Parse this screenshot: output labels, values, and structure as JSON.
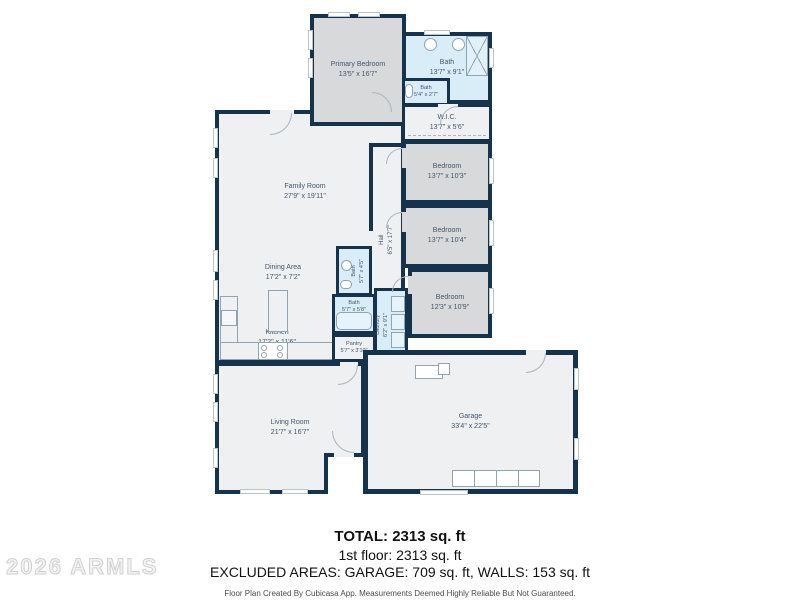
{
  "watermark": "2026 ARMLS",
  "summary": {
    "total": "TOTAL: 2313 sq. ft",
    "floor1": "1st floor: 2313 sq. ft",
    "excluded": "EXCLUDED AREAS: GARAGE: 709 sq. ft, WALLS: 153 sq. ft",
    "disclaimer": "Floor Plan Created By Cubicasa App. Measurements Deemed Highly Reliable But Not Guaranteed."
  },
  "colors": {
    "wall": "#16334e",
    "room_light": "#eef0f2",
    "room_gray": "#d7d9da",
    "room_blue": "#d9edf9",
    "label_text": "#44566b"
  },
  "rooms": {
    "primary_bedroom": {
      "name": "Primary Bedroom",
      "dims": "13'5\" x 16'7\""
    },
    "bath_primary": {
      "name": "Bath",
      "dims": "13'7\" x 9'1\""
    },
    "bath_small": {
      "name": "Bath",
      "dims": "5'4\" x 2'7\""
    },
    "wic": {
      "name": "W.I.C.",
      "dims": "13'7\" x 5'6\""
    },
    "family_room": {
      "name": "Family Room",
      "dims": "27'9\" x 19'11\""
    },
    "hall": {
      "name": "Hall",
      "dims": "6'5\" x 17'7\""
    },
    "bedroom_1": {
      "name": "Bedroom",
      "dims": "13'7\" x 10'3\""
    },
    "bedroom_2": {
      "name": "Bedroom",
      "dims": "13'7\" x 10'4\""
    },
    "bedroom_3": {
      "name": "Bedroom",
      "dims": "12'3\" x 10'9\""
    },
    "dining_area": {
      "name": "Dining Area",
      "dims": "17'2\" x 7'2\""
    },
    "kitchen": {
      "name": "Kitchen",
      "dims": "17'2\" x 11'6\""
    },
    "bath_hall": {
      "name": "Bath",
      "dims": "5'7\" x 4'5\""
    },
    "bath_tub": {
      "name": "Bath",
      "dims": "5'7\" x 5'8\""
    },
    "pantry": {
      "name": "Pantry",
      "dims": "5'7\" x 3'10\""
    },
    "laundry": {
      "name": "Laundry",
      "dims": "6'2\" x 9'1\""
    },
    "living_room": {
      "name": "Living Room",
      "dims": "21'7\" x 16'7\""
    },
    "garage": {
      "name": "Garage",
      "dims": "33'4\" x 22'5\""
    }
  }
}
